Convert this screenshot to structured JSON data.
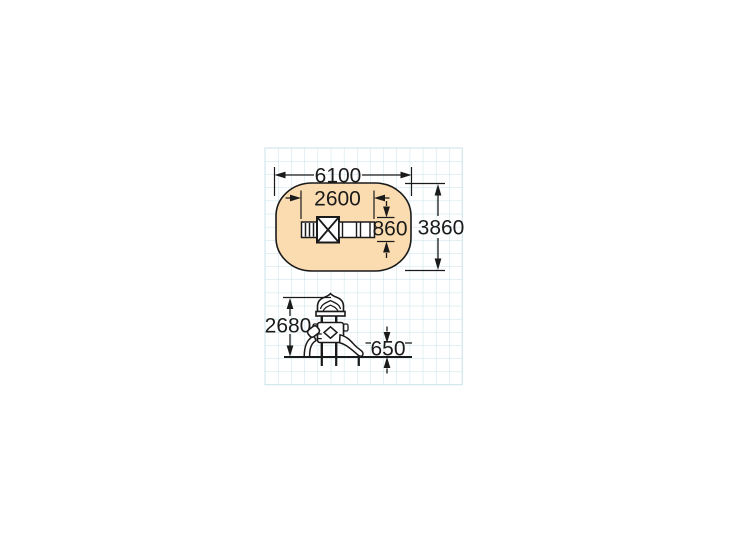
{
  "drawing": {
    "colors": {
      "safety_area_fill": "#FBDCB0",
      "grid_line": "#C8E2E8",
      "ink": "#1A1A1A"
    },
    "top_view": {
      "dim_length": "6100",
      "dim_width": "3860",
      "dim_unit_length": "2600",
      "dim_unit_width": "860"
    },
    "side_view": {
      "dim_total_height": "2680",
      "dim_slide_height": "650"
    }
  }
}
